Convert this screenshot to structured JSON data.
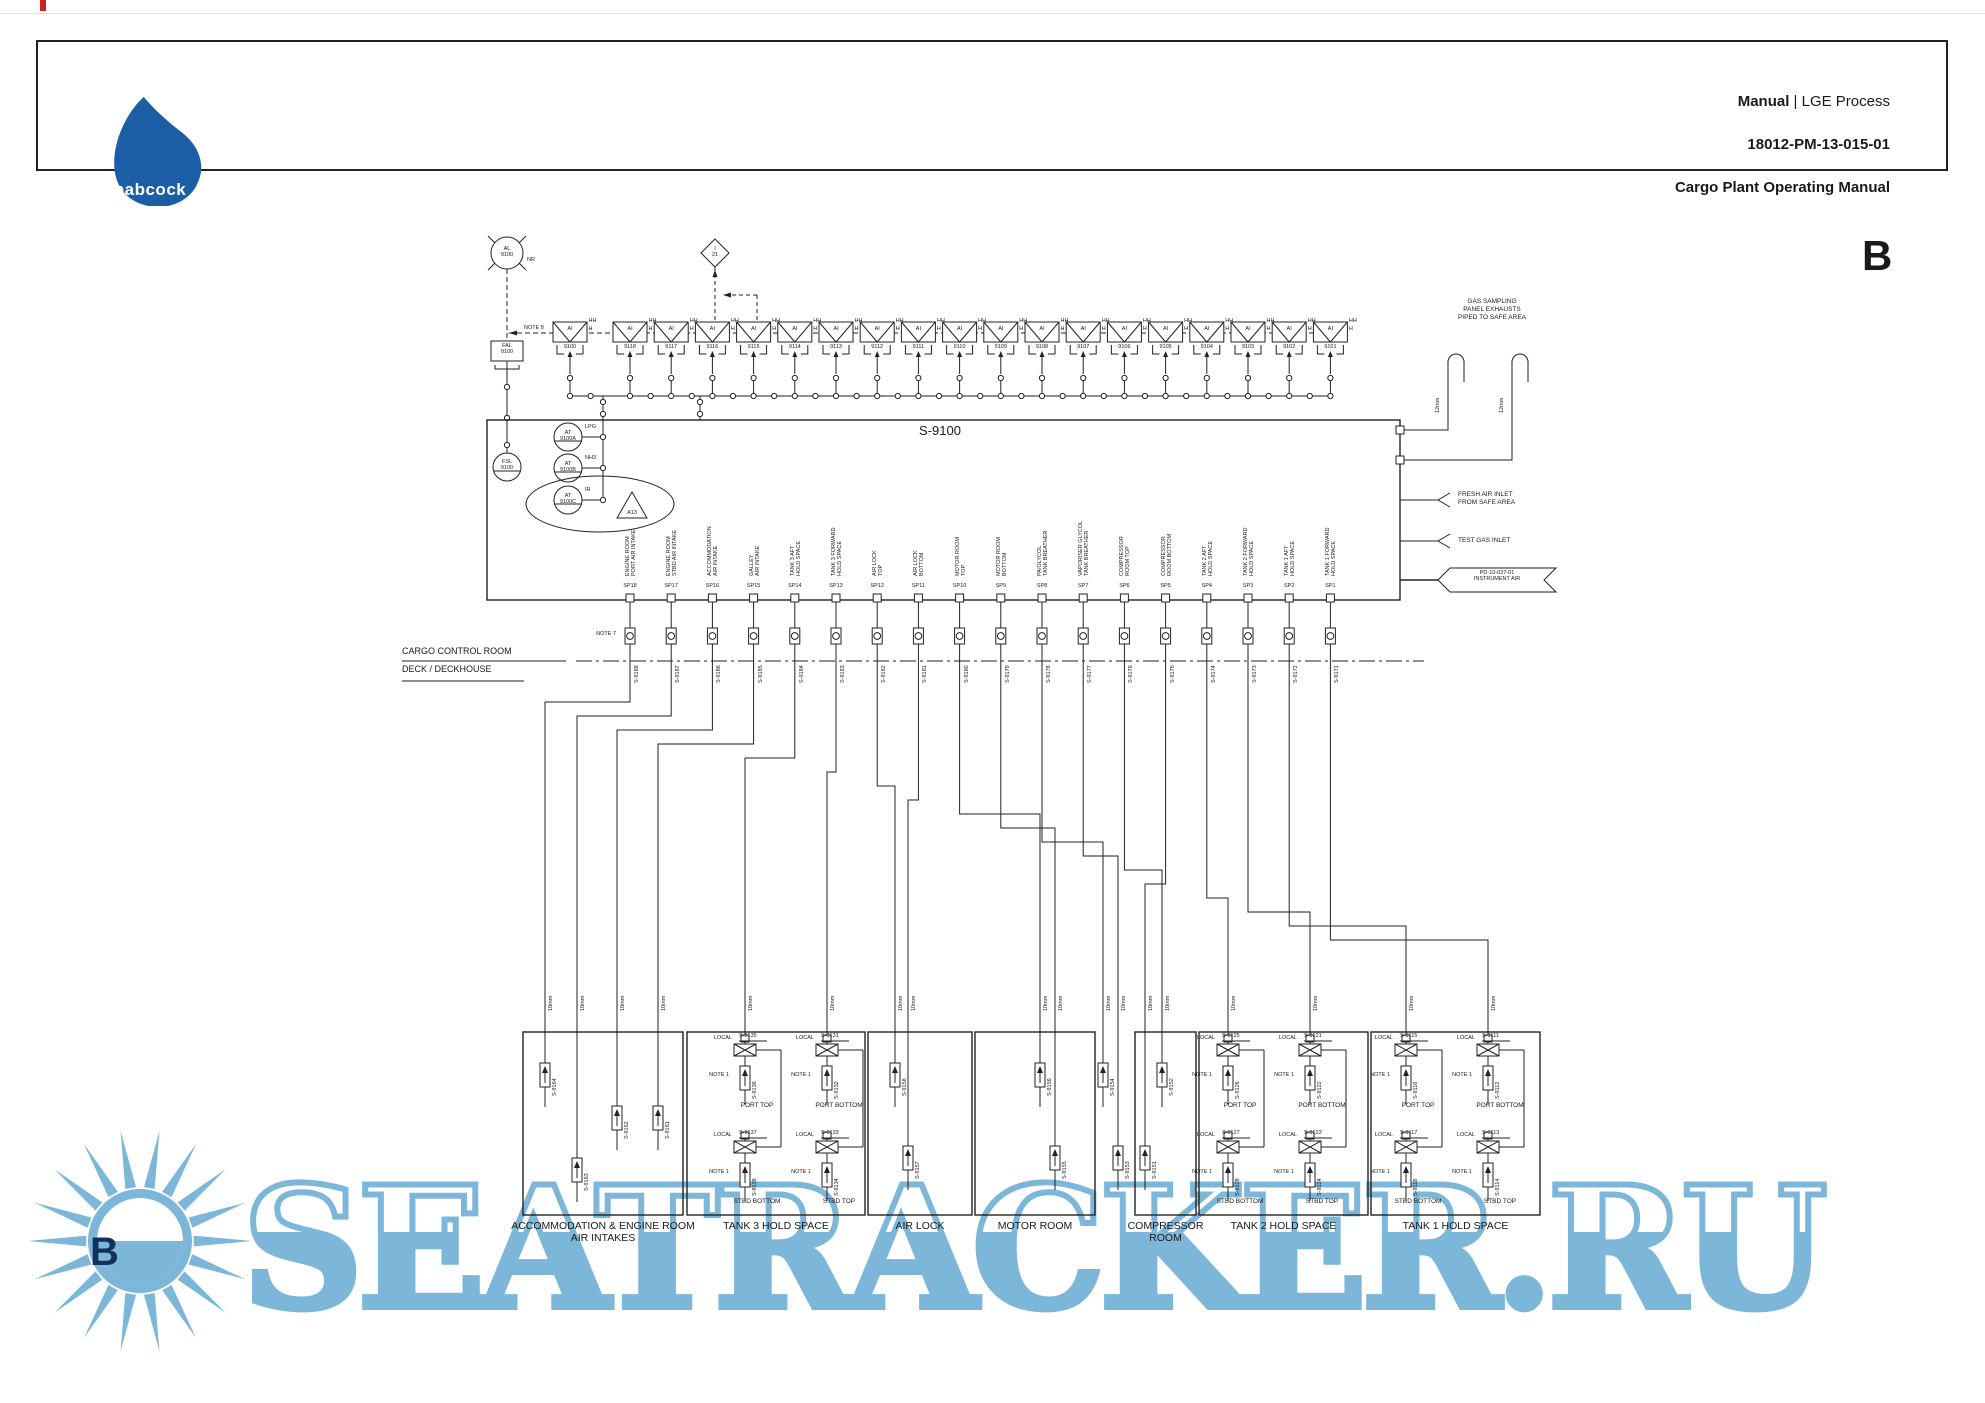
{
  "page": {
    "header": {
      "logo_text": "babcock",
      "title_bold": "Manual",
      "title_rest": " | LGE Process",
      "doc_number": "18012-PM-13-015-01",
      "subtitle": "Cargo Plant Operating Manual"
    },
    "revision": "B"
  },
  "notes": {
    "note8": "NOTE 8",
    "note7": "NOTE 7",
    "note1": "NOTE 1",
    "local": "LOCAL"
  },
  "alarm_loop": {
    "alarm_unit": {
      "tag": "AL\n9100",
      "suffix": "NR"
    },
    "interlock": {
      "tag": "I\n21"
    },
    "fal": {
      "tag": "FAL\n9100"
    },
    "fsl": {
      "tag": "FSL\n9100"
    }
  },
  "detectors": {
    "label": "AI",
    "hh": "HH",
    "h": "H",
    "common": "9100",
    "tags": [
      "9118",
      "9117",
      "9116",
      "9115",
      "9114",
      "9113",
      "9112",
      "9111",
      "9110",
      "9109",
      "9108",
      "9107",
      "9106",
      "9105",
      "9104",
      "9103",
      "9102",
      "9101"
    ]
  },
  "analyser_panel": {
    "tag": "S-9100",
    "analysers": [
      {
        "tag": "AT\n9100A",
        "gas": "LPG"
      },
      {
        "tag": "AT\n9100B",
        "gas": "NH3"
      },
      {
        "tag": "AT\n9100C",
        "gas": "IR"
      }
    ],
    "alarm_ref": "A13"
  },
  "sample_points": [
    {
      "sp": "SP18",
      "desc": "ENGINE ROOM\nPORT AIR INTAKE",
      "valve": "S-9188"
    },
    {
      "sp": "SP17",
      "desc": "ENGINE ROOM\nSTBD AIR INTAKE",
      "valve": "S-9187"
    },
    {
      "sp": "SP16",
      "desc": "ACCOMMODATION\nAIR INTAKE",
      "valve": "S-9186"
    },
    {
      "sp": "SP15",
      "desc": "GALLEY\nAIR INTAKE",
      "valve": "S-9185"
    },
    {
      "sp": "SP14",
      "desc": "TANK 3 AFT\nHOLD SPACE",
      "valve": "S-9184"
    },
    {
      "sp": "SP13",
      "desc": "TANK 3 FORWARD\nHOLD SPACE",
      "valve": "S-9183"
    },
    {
      "sp": "SP12",
      "desc": "AIR LOCK\nTOP",
      "valve": "S-9182"
    },
    {
      "sp": "SP11",
      "desc": "AIR LOCK\nBOTTOM",
      "valve": "S-9181"
    },
    {
      "sp": "SP10",
      "desc": "MOTOR ROOM\nTOP",
      "valve": "S-9180"
    },
    {
      "sp": "SP9",
      "desc": "MOTOR ROOM\nBOTTOM",
      "valve": "S-9179"
    },
    {
      "sp": "SP8",
      "desc": "PA/GLYCOL\nTANK BREATHER",
      "valve": "S-9178"
    },
    {
      "sp": "SP7",
      "desc": "VAPORISER GLYCOL\nTANK BREATHER",
      "valve": "S-9177"
    },
    {
      "sp": "SP6",
      "desc": "COMPRESSOR\nROOM TOP",
      "valve": "S-9176"
    },
    {
      "sp": "SP5",
      "desc": "COMPRESSOR\nROOM BOTTOM",
      "valve": "S-9175"
    },
    {
      "sp": "SP4",
      "desc": "TANK 2 AFT\nHOLD SPACE",
      "valve": "S-9174"
    },
    {
      "sp": "SP3",
      "desc": "TANK 2 FORWARD\nHOLD SPACE",
      "valve": "S-9173"
    },
    {
      "sp": "SP2",
      "desc": "TANK 1 AFT\nHOLD SPACE",
      "valve": "S-9172"
    },
    {
      "sp": "SP1",
      "desc": "TANK 1 FORWARD\nHOLD SPACE",
      "valve": "S-9171"
    }
  ],
  "boundary": {
    "upper": "CARGO CONTROL ROOM",
    "lower": "DECK / DECKHOUSE"
  },
  "pipe_sizes": {
    "drop": "10mm",
    "vent": "12mm"
  },
  "right_side": {
    "exhaust_note": "GAS SAMPLING\nPANEL EXHAUSTS\nPIPED TO SAFE AREA",
    "fresh_air": "FRESH AIR INLET\nFROM SAFE AREA",
    "test_gas": "TEST GAS INLET",
    "instrument_air": "PD-10-037-01\nINSTRUMENT AIR"
  },
  "spaces": [
    {
      "name": "ACCOMMODATION & ENGINE ROOM\nAIR INTAKES",
      "filters": [
        {
          "tag": "S-9164"
        },
        {
          "tag": "S-9163"
        },
        {
          "tag": "S-9162"
        },
        {
          "tag": "S-9161"
        }
      ]
    },
    {
      "name": "TANK 3 HOLD SPACE",
      "locals": [
        {
          "valve": "S-9135",
          "filter": "S-9136",
          "position": "PORT TOP"
        },
        {
          "valve": "S-9131",
          "filter": "S-9132",
          "position": "PORT BOTTOM"
        },
        {
          "valve": "S-9137",
          "filter": "S-9138",
          "position": "STBD BOTTOM"
        },
        {
          "valve": "S-9133",
          "filter": "S-9134",
          "position": "STBD TOP"
        }
      ]
    },
    {
      "name": "AIR LOCK",
      "filters": [
        {
          "tag": "S-9158"
        },
        {
          "tag": "S-9157"
        }
      ]
    },
    {
      "name": "MOTOR ROOM",
      "filters": [
        {
          "tag": "S-9156"
        },
        {
          "tag": "S-9155"
        }
      ]
    },
    {
      "name": "COMPRESSOR\nROOM",
      "filters": [
        {
          "tag": "S-9152"
        },
        {
          "tag": "S-9151"
        }
      ]
    },
    {
      "name": "TANK 2 HOLD SPACE",
      "locals": [
        {
          "valve": "S-9125",
          "filter": "S-9126",
          "position": "PORT TOP"
        },
        {
          "valve": "S-9121",
          "filter": "S-9122",
          "position": "PORT BOTTOM"
        },
        {
          "valve": "S-9127",
          "filter": "S-9128",
          "position": "STBD BOTTOM"
        },
        {
          "valve": "S-9123",
          "filter": "S-9124",
          "position": "STBD TOP"
        }
      ]
    },
    {
      "name": "TANK 1 HOLD SPACE",
      "locals": [
        {
          "valve": "S-9115",
          "filter": "S-9116",
          "position": "PORT TOP"
        },
        {
          "valve": "S-9111",
          "filter": "S-9112",
          "position": "PORT BOTTOM"
        },
        {
          "valve": "S-9117",
          "filter": "S-9118",
          "position": "STBD BOTTOM"
        },
        {
          "valve": "S-9113",
          "filter": "S-9114",
          "position": "STBD TOP"
        }
      ]
    }
  ],
  "breather_filters": [
    {
      "tag": "S-9154"
    },
    {
      "tag": "S-9153"
    }
  ],
  "watermark": {
    "text": "SEATRACKER.RU",
    "badge_letter": "B"
  },
  "colors": {
    "line": "#222222",
    "logo_blue": "#1b5ea6",
    "watermark_blue": "#7cb6d9",
    "red_mark": "#cc2222"
  }
}
